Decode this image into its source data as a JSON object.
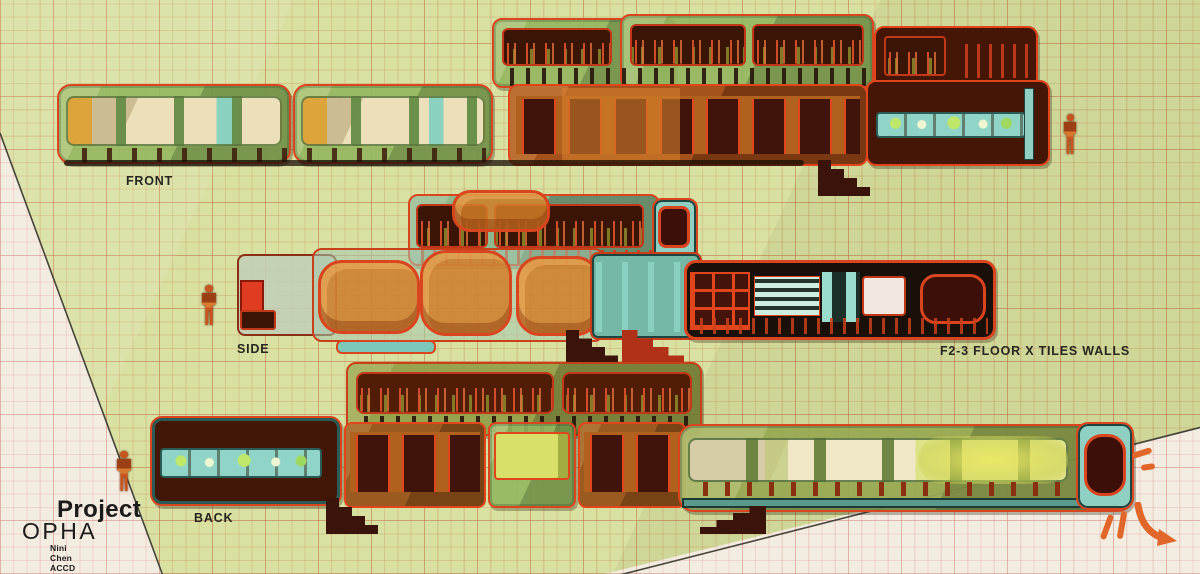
{
  "title": {
    "project": "Project",
    "name": "OPHA",
    "byline": "Nini Chen ACCD SP24"
  },
  "labels": {
    "front": "FRONT",
    "side": "SIDE",
    "back": "BACK",
    "floor_note": "F2-3 FLOOR X TILES WALLS"
  },
  "colors": {
    "paper_green": "#d8e0a2",
    "paper_white": "#f3ece1",
    "grid_orange": "#ba623a",
    "grid_pink": "#cd7d73",
    "accent_red": "#d8451f",
    "ink": "#26261f",
    "hand_orange": "#e0662a"
  },
  "scene": {
    "views": [
      {
        "name": "front-elevation-drawing",
        "parts": [
          {
            "name": "front-deck-module-left",
            "cls": "gm",
            "x": 492,
            "y": 18,
            "w": 184,
            "h": 70,
            "r": 10
          },
          {
            "name": "front-deck-module-right",
            "cls": "gm",
            "x": 620,
            "y": 14,
            "w": 254,
            "h": 74,
            "r": 10
          },
          {
            "name": "front-deck-window-1",
            "cls": "win-plants",
            "x": 502,
            "y": 28,
            "w": 110,
            "h": 38,
            "r": 6
          },
          {
            "name": "front-deck-window-2",
            "cls": "win-plants",
            "x": 630,
            "y": 24,
            "w": 116,
            "h": 42,
            "r": 6
          },
          {
            "name": "front-deck-window-3",
            "cls": "win-plants",
            "x": 752,
            "y": 24,
            "w": 112,
            "h": 42,
            "r": 6
          },
          {
            "name": "front-deck-railing",
            "cls": "slats-dark",
            "x": 498,
            "y": 68,
            "w": 370,
            "h": 18
          },
          {
            "name": "front-upper-right-module",
            "cls": "dm",
            "x": 874,
            "y": 26,
            "w": 164,
            "h": 62,
            "r": 10
          },
          {
            "name": "front-upper-right-window",
            "cls": "win-plants",
            "x": 884,
            "y": 36,
            "w": 62,
            "h": 40,
            "r": 4
          },
          {
            "name": "front-upper-right-slats",
            "cls": "slats-red",
            "x": 956,
            "y": 44,
            "w": 76,
            "h": 34
          },
          {
            "name": "front-main-module-1",
            "cls": "gm",
            "x": 57,
            "y": 84,
            "w": 234,
            "h": 80,
            "r": 14
          },
          {
            "name": "front-main-module-2",
            "cls": "gm",
            "x": 293,
            "y": 84,
            "w": 200,
            "h": 80,
            "r": 14
          },
          {
            "name": "front-main-windows-1",
            "cls": "win-cream",
            "x": 66,
            "y": 96,
            "w": 216,
            "h": 50,
            "r": 8
          },
          {
            "name": "front-main-windows-2",
            "cls": "win-cream",
            "x": 301,
            "y": 96,
            "w": 184,
            "h": 50,
            "r": 8
          },
          {
            "name": "front-main-railing",
            "cls": "slats",
            "x": 62,
            "y": 148,
            "w": 424,
            "h": 14
          },
          {
            "name": "front-main-orange-module",
            "cls": "om",
            "x": 508,
            "y": 84,
            "w": 360,
            "h": 82,
            "r": 10
          },
          {
            "name": "front-orange-door-panels",
            "cls": "arches",
            "x": 516,
            "y": 96,
            "w": 344,
            "h": 58
          },
          {
            "name": "front-orange-center-bay",
            "cls": "om-bright",
            "x": 562,
            "y": 88,
            "w": 118,
            "h": 74
          },
          {
            "name": "front-main-dark-module",
            "cls": "dm",
            "x": 866,
            "y": 80,
            "w": 184,
            "h": 86,
            "r": 10
          },
          {
            "name": "front-dark-counter",
            "cls": "bottles",
            "x": 876,
            "y": 112,
            "w": 150,
            "h": 26
          },
          {
            "name": "front-dark-pipe",
            "cls": "teal-pipe",
            "x": 1024,
            "y": 88,
            "w": 10,
            "h": 72
          },
          {
            "name": "front-base-shadow",
            "cls": "shadow-strip",
            "x": 64,
            "y": 160,
            "w": 740,
            "h": 6
          },
          {
            "name": "front-stairs",
            "cls": "stairs",
            "x": 818,
            "y": 160,
            "w": 52,
            "h": 36
          }
        ]
      },
      {
        "name": "side-elevation-drawing",
        "parts": [
          {
            "name": "side-deck-module",
            "cls": "gm-teal",
            "x": 408,
            "y": 194,
            "w": 252,
            "h": 72,
            "r": 10
          },
          {
            "name": "side-deck-window-1",
            "cls": "win-plants",
            "x": 416,
            "y": 204,
            "w": 72,
            "h": 44,
            "r": 6
          },
          {
            "name": "side-deck-window-2",
            "cls": "win-plants",
            "x": 494,
            "y": 204,
            "w": 150,
            "h": 44,
            "r": 6
          },
          {
            "name": "side-deck-railing",
            "cls": "slats-red",
            "x": 412,
            "y": 250,
            "w": 246,
            "h": 14
          },
          {
            "name": "side-deck-end-module",
            "cls": "tealm",
            "x": 652,
            "y": 198,
            "w": 46,
            "h": 66,
            "r": 10
          },
          {
            "name": "side-deck-end-window",
            "cls": "win-maroon",
            "x": 658,
            "y": 206,
            "w": 32,
            "h": 42,
            "r": 8
          },
          {
            "name": "side-main-glass-left",
            "cls": "glassm",
            "x": 237,
            "y": 254,
            "w": 100,
            "h": 82,
            "r": 8
          },
          {
            "name": "side-left-red-block",
            "cls": "red-block",
            "x": 240,
            "y": 280,
            "w": 24,
            "h": 34
          },
          {
            "name": "side-left-dark-window",
            "cls": "win-dark",
            "x": 240,
            "y": 310,
            "w": 36,
            "h": 20,
            "r": 3
          },
          {
            "name": "side-main-glass-mid",
            "cls": "glassm2",
            "x": 312,
            "y": 248,
            "w": 292,
            "h": 94,
            "r": 10
          },
          {
            "name": "side-sofa-blob-top",
            "cls": "blob",
            "x": 452,
            "y": 190,
            "w": 98,
            "h": 42,
            "r": 18
          },
          {
            "name": "side-sofa-blob-1",
            "cls": "blob",
            "x": 318,
            "y": 260,
            "w": 102,
            "h": 74,
            "r": 24
          },
          {
            "name": "side-sofa-blob-2",
            "cls": "blob",
            "x": 420,
            "y": 250,
            "w": 92,
            "h": 86,
            "r": 26
          },
          {
            "name": "side-sofa-blob-3",
            "cls": "blob",
            "x": 516,
            "y": 256,
            "w": 84,
            "h": 80,
            "r": 24
          },
          {
            "name": "side-mid-teal-module",
            "cls": "tealm2",
            "x": 590,
            "y": 252,
            "w": 112,
            "h": 88,
            "r": 8
          },
          {
            "name": "side-mid-posts",
            "cls": "posts-teal",
            "x": 596,
            "y": 262,
            "w": 100,
            "h": 70
          },
          {
            "name": "side-main-black-module",
            "cls": "blackm",
            "x": 684,
            "y": 260,
            "w": 312,
            "h": 80,
            "r": 12
          },
          {
            "name": "side-black-red-grid",
            "cls": "red-grid",
            "x": 690,
            "y": 272,
            "w": 60,
            "h": 58
          },
          {
            "name": "side-black-louvers",
            "cls": "louvers",
            "x": 754,
            "y": 276,
            "w": 66,
            "h": 40
          },
          {
            "name": "side-black-teal-panels",
            "cls": "posts-teal2",
            "x": 822,
            "y": 272,
            "w": 38,
            "h": 50
          },
          {
            "name": "side-black-white-window",
            "cls": "win-white",
            "x": 862,
            "y": 276,
            "w": 44,
            "h": 40,
            "r": 4
          },
          {
            "name": "side-black-dark-window",
            "cls": "win-maroon",
            "x": 920,
            "y": 274,
            "w": 66,
            "h": 50,
            "r": 16
          },
          {
            "name": "side-black-slats",
            "cls": "slats-dark2",
            "x": 690,
            "y": 318,
            "w": 298,
            "h": 16
          },
          {
            "name": "side-skid",
            "cls": "tealskid",
            "x": 336,
            "y": 340,
            "w": 100,
            "h": 14,
            "r": 6
          },
          {
            "name": "side-stairs",
            "cls": "stairs",
            "x": 566,
            "y": 330,
            "w": 52,
            "h": 34
          },
          {
            "name": "side-red-stairs",
            "cls": "stairs stairs-red",
            "x": 622,
            "y": 330,
            "w": 62,
            "h": 34
          }
        ]
      },
      {
        "name": "back-elevation-drawing",
        "parts": [
          {
            "name": "back-deck-module",
            "cls": "gm-olive",
            "x": 346,
            "y": 362,
            "w": 356,
            "h": 74,
            "r": 10
          },
          {
            "name": "back-deck-window-1",
            "cls": "win-plants2",
            "x": 356,
            "y": 372,
            "w": 198,
            "h": 42,
            "r": 8
          },
          {
            "name": "back-deck-window-2",
            "cls": "win-plants2",
            "x": 562,
            "y": 372,
            "w": 130,
            "h": 42,
            "r": 8
          },
          {
            "name": "back-deck-railing",
            "cls": "slats-dark",
            "x": 352,
            "y": 416,
            "w": 346,
            "h": 16
          },
          {
            "name": "back-main-dark-module",
            "cls": "dm2",
            "x": 150,
            "y": 416,
            "w": 192,
            "h": 90,
            "r": 12
          },
          {
            "name": "back-dark-counter",
            "cls": "bottles",
            "x": 160,
            "y": 448,
            "w": 162,
            "h": 30
          },
          {
            "name": "back-main-module-1",
            "cls": "om2",
            "x": 344,
            "y": 422,
            "w": 142,
            "h": 86,
            "r": 8
          },
          {
            "name": "back-module-1-panels",
            "cls": "arches",
            "x": 350,
            "y": 432,
            "w": 130,
            "h": 60
          },
          {
            "name": "back-main-module-2",
            "cls": "gm",
            "x": 488,
            "y": 422,
            "w": 88,
            "h": 86,
            "r": 8
          },
          {
            "name": "back-module-2-window",
            "cls": "win-yellow",
            "x": 494,
            "y": 432,
            "w": 76,
            "h": 48,
            "r": 4
          },
          {
            "name": "back-main-module-3",
            "cls": "om2",
            "x": 578,
            "y": 422,
            "w": 108,
            "h": 86,
            "r": 8
          },
          {
            "name": "back-module-3-panels",
            "cls": "arches",
            "x": 584,
            "y": 432,
            "w": 96,
            "h": 60
          },
          {
            "name": "back-main-long-module",
            "cls": "gm-olive2",
            "x": 678,
            "y": 424,
            "w": 456,
            "h": 88,
            "r": 16
          },
          {
            "name": "back-long-windows",
            "cls": "win-cream2",
            "x": 688,
            "y": 438,
            "w": 380,
            "h": 44,
            "r": 8
          },
          {
            "name": "back-long-glow",
            "cls": "glow-yellow",
            "x": 918,
            "y": 436,
            "w": 150,
            "h": 48
          },
          {
            "name": "back-long-posts",
            "cls": "slats-rust",
            "x": 686,
            "y": 482,
            "w": 390,
            "h": 14
          },
          {
            "name": "back-long-base",
            "cls": "teal-base",
            "x": 682,
            "y": 498,
            "w": 442,
            "h": 10
          },
          {
            "name": "back-end-cap",
            "cls": "tealm",
            "x": 1076,
            "y": 422,
            "w": 58,
            "h": 88,
            "r": 12
          },
          {
            "name": "back-end-window",
            "cls": "win-maroon",
            "x": 1084,
            "y": 434,
            "w": 42,
            "h": 62,
            "r": 18
          },
          {
            "name": "back-stairs-1",
            "cls": "stairs",
            "x": 326,
            "y": 498,
            "w": 52,
            "h": 36
          },
          {
            "name": "back-stairs-2",
            "cls": "stairs stairs-left",
            "x": 700,
            "y": 506,
            "w": 66,
            "h": 28
          }
        ]
      }
    ],
    "figures": [
      {
        "name": "scale-figure-front",
        "x": 1062,
        "y": 114,
        "w": 16,
        "h": 40
      },
      {
        "name": "scale-figure-side",
        "x": 200,
        "y": 285,
        "w": 18,
        "h": 40
      },
      {
        "name": "scale-figure-back",
        "x": 115,
        "y": 451,
        "w": 18,
        "h": 40
      }
    ],
    "marks": [
      {
        "name": "hand-dash-1",
        "x": 1132,
        "y": 450,
        "w": 20,
        "h": 6,
        "rot": -18
      },
      {
        "name": "hand-dash-2",
        "x": 1141,
        "y": 464,
        "w": 14,
        "h": 6,
        "rot": -8
      },
      {
        "name": "hand-slash-1",
        "x": 1104,
        "y": 514,
        "w": 6,
        "h": 26,
        "rot": 20
      },
      {
        "name": "hand-slash-2",
        "x": 1119,
        "y": 511,
        "w": 6,
        "h": 28,
        "rot": 10
      }
    ]
  }
}
